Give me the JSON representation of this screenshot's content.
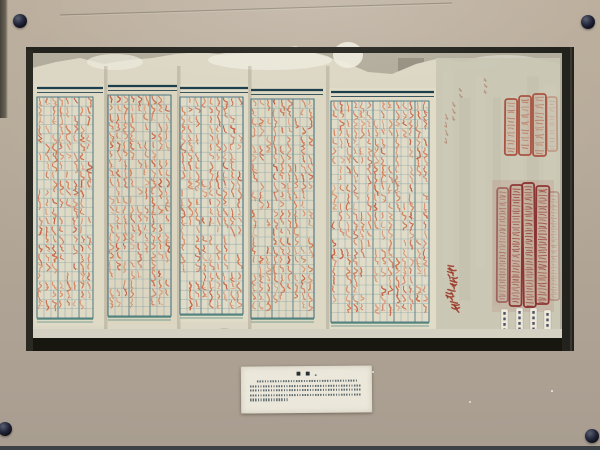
{
  "scene": {
    "description": "Photograph of a glass museum display case containing a long historical Chinese roster document: five grid pages densely filled with red-ink characters, faint brush annotations and red official seal impressions on the right end, four small paper tags below the seals, and a white printed exhibit label (illegible at this resolution) mounted on the tan mat beneath the document.",
    "legible_text": false
  },
  "colors": {
    "mat": "#b3a797",
    "mat_edge_dark": "#46423a",
    "recess_frame": "#23221d",
    "recess_side": "#2b2a22",
    "backing": "#b2ac9c",
    "backing_notch": "#8e897a",
    "paper": "#dcd7c4",
    "paper_bright": "#eeebde",
    "paper_right_section": "#c8c5b2",
    "ledge": "#d5d1c2",
    "shadow_bar": "#17160f",
    "grid_line": "#5d8a99",
    "grid_dark": "#2f6375",
    "panel_header": "#1d3f4d",
    "panel_bottom_line": "#3a7a70",
    "glyph_palette": [
      "#d06a42",
      "#c85f3a",
      "#d4764e",
      "#c05536",
      "#da825b"
    ],
    "seal_top_border": "#a84a38",
    "seal_top_inner": "#b86a55",
    "seal_bottom_border": "#8a3030",
    "seal_bottom_inner": "#943832",
    "signature_red": "#9c3524",
    "tag_paper": "#eee9da",
    "tag_mark": "#2e3a52",
    "label_bg": "#ebe7da",
    "label_text": "#46565c",
    "screw": "#0c0d15",
    "wire": "#7d7668"
  },
  "frame": {
    "screws": [
      {
        "x": 20,
        "y": 21,
        "d": 14
      },
      {
        "x": 588,
        "y": 22,
        "d": 14
      },
      {
        "x": 5,
        "y": 429,
        "d": 14
      },
      {
        "x": 592,
        "y": 436,
        "d": 14
      }
    ],
    "wire": {
      "x1": 60,
      "y1": 15,
      "x2": 452,
      "y2": 3
    }
  },
  "recess": {
    "x": 28,
    "y": 47,
    "w": 546,
    "h": 304,
    "top_bar": {
      "x": 26,
      "y": 47,
      "w": 548,
      "h": 6
    },
    "left_strip": {
      "x": 26,
      "y": 50,
      "w": 7,
      "h": 301
    },
    "right_strip": {
      "x": 562,
      "y": 50,
      "w": 12,
      "h": 301
    },
    "ledge": {
      "x": 30,
      "y": 329,
      "w": 532,
      "h": 10
    },
    "shadow_bar": {
      "x": 28,
      "y": 338,
      "w": 546,
      "h": 13
    },
    "backing_notch": {
      "x": 398,
      "y": 58,
      "w": 26,
      "h": 16
    }
  },
  "document": {
    "paper_top_y": [
      68,
      62,
      58,
      64,
      60,
      58,
      54,
      52,
      55,
      53,
      50,
      46,
      55,
      62,
      72,
      74,
      64,
      58,
      62,
      60,
      62,
      58,
      64
    ],
    "paper_left": 32,
    "paper_right": 560,
    "paper_bottom": 332,
    "bright_patches": [
      {
        "cx": 270,
        "cy": 60,
        "rx": 62,
        "ry": 10,
        "o": 0.8
      },
      {
        "cx": 348,
        "cy": 55,
        "rx": 15,
        "ry": 13,
        "o": 0.9
      },
      {
        "cx": 115,
        "cy": 62,
        "rx": 28,
        "ry": 8,
        "o": 0.7
      },
      {
        "cx": 505,
        "cy": 64,
        "rx": 40,
        "ry": 9,
        "o": 0.5
      }
    ],
    "right_section": {
      "x": 436,
      "y": 58,
      "w": 124,
      "h": 274
    },
    "panels": [
      {
        "x": 37,
        "w": 66,
        "top": 88,
        "bottom": 322,
        "cols": 8,
        "tint": "#dfdac6"
      },
      {
        "x": 108,
        "w": 69,
        "top": 86,
        "bottom": 320,
        "cols": 9,
        "tint": "#dcd6c1"
      },
      {
        "x": 180,
        "w": 68,
        "top": 88,
        "bottom": 318,
        "cols": 9,
        "tint": "#e0dbc7"
      },
      {
        "x": 251,
        "w": 72,
        "top": 90,
        "bottom": 322,
        "cols": 9,
        "tint": "#ddd8c3"
      },
      {
        "x": 331,
        "w": 103,
        "top": 92,
        "bottom": 326,
        "cols": 14,
        "tint": "#e1dcc8"
      }
    ],
    "cell": {
      "w": 7,
      "h": 9.2
    },
    "fill_probability": 0.82,
    "creases_x": [
      105,
      178,
      249,
      327
    ],
    "annotations": [
      {
        "x": 484,
        "y": 78,
        "n": 3,
        "s": 4
      },
      {
        "x": 459,
        "y": 88,
        "n": 2,
        "s": 4
      },
      {
        "x": 452,
        "y": 102,
        "n": 3,
        "s": 5
      },
      {
        "x": 445,
        "y": 114,
        "n": 4,
        "s": 6
      }
    ]
  },
  "seals": {
    "top": [
      {
        "x": 505,
        "y": 99,
        "w": 12,
        "h": 56
      },
      {
        "x": 519,
        "y": 96,
        "w": 12,
        "h": 59
      },
      {
        "x": 533,
        "y": 94,
        "w": 13,
        "h": 62
      }
    ],
    "top_echo": {
      "x": 547,
      "y": 97,
      "w": 10,
      "h": 54
    },
    "bottom": [
      {
        "x": 497,
        "y": 188,
        "w": 11,
        "h": 114
      },
      {
        "x": 510,
        "y": 185,
        "w": 12,
        "h": 121
      },
      {
        "x": 523,
        "y": 183,
        "w": 12,
        "h": 124
      },
      {
        "x": 536,
        "y": 186,
        "w": 13,
        "h": 118
      }
    ],
    "bottom_echo": {
      "x": 549,
      "y": 192,
      "w": 10,
      "h": 108
    }
  },
  "signature": {
    "x": 445,
    "y": 264,
    "count": 4,
    "size": 11
  },
  "tags": [
    {
      "x": 501,
      "y": 309,
      "w": 7,
      "h": 26
    },
    {
      "x": 516,
      "y": 308,
      "w": 7,
      "h": 27
    },
    {
      "x": 530,
      "y": 308,
      "w": 7,
      "h": 27
    },
    {
      "x": 544,
      "y": 310,
      "w": 7,
      "h": 25
    }
  ],
  "label_card": {
    "title_marks": "■ ■",
    "title_small_mark": "▪",
    "lines": [
      {
        "indent": 0.08,
        "width": 0.86
      },
      {
        "indent": 0.02,
        "width": 0.95
      },
      {
        "indent": 0.02,
        "width": 0.95
      },
      {
        "indent": 0.02,
        "width": 0.95
      },
      {
        "indent": 0.02,
        "width": 0.33
      }
    ]
  },
  "specks": [
    {
      "x": 372,
      "y": 371,
      "d": 2
    },
    {
      "x": 469,
      "y": 401,
      "d": 2
    },
    {
      "x": 551,
      "y": 390,
      "d": 1.5
    }
  ]
}
